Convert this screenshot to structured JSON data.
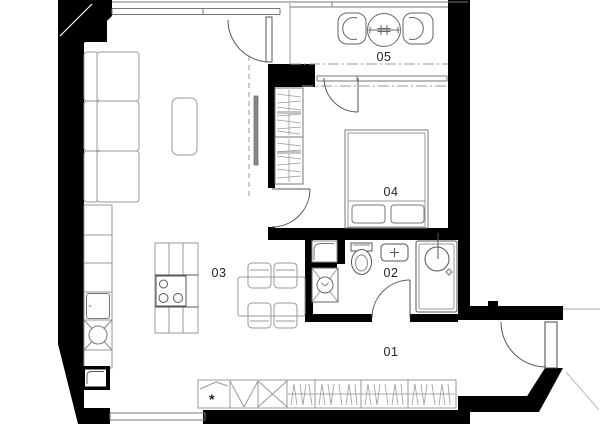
{
  "plan": {
    "kind": "apartment-floor-plan",
    "rooms": [
      {
        "number": "01",
        "name": "hallway"
      },
      {
        "number": "02",
        "name": "bathroom"
      },
      {
        "number": "03",
        "name": "living-room-kitchen"
      },
      {
        "number": "04",
        "name": "bedroom"
      },
      {
        "number": "05",
        "name": "balcony"
      }
    ]
  },
  "rooms": [
    {
      "label": "01"
    },
    {
      "label": "02"
    },
    {
      "label": "03"
    },
    {
      "label": "04"
    },
    {
      "label": "05"
    }
  ],
  "symbols": {
    "shoe_cabinet_star": "*"
  },
  "colors": {
    "wall": "#000000",
    "background": "#ffffff",
    "furniture_outline": "#999999",
    "fixture_outline": "#555555",
    "label_text": "#222222",
    "dash_line": "#9a9a9a"
  }
}
